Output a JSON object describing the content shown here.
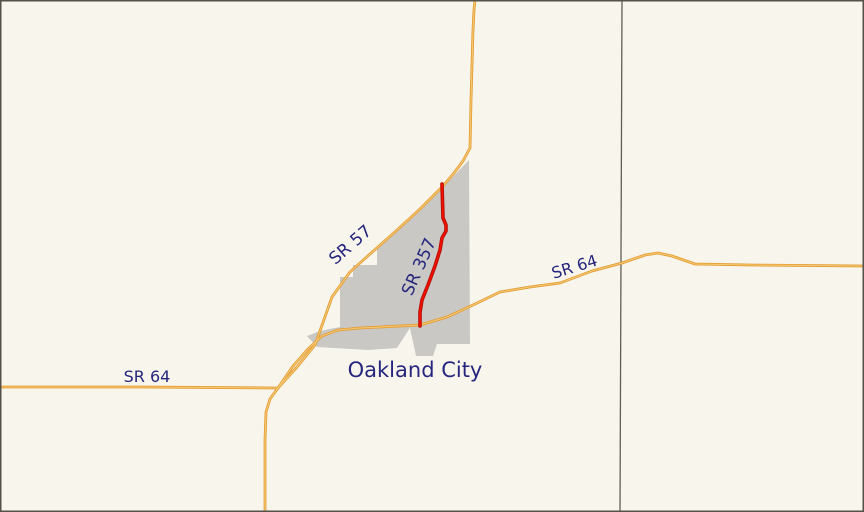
{
  "map": {
    "background_color": "#f8f6ec",
    "border_color": "#53524a"
  },
  "colors": {
    "highway_casing": "#e29d36",
    "highway_fill": "#f7c873",
    "route_casing": "#b50d00",
    "route_fill": "#f01000",
    "urban_area": "#c9c8c5",
    "boundary_line": "#5f5e56",
    "label": "#26267e"
  },
  "labels": {
    "city": {
      "text": "Oakland City"
    },
    "sr57": {
      "text": "SR 57"
    },
    "sr357": {
      "text": "SR 357"
    },
    "sr64_west": {
      "text": "SR 64"
    },
    "sr64_east": {
      "text": "SR 64"
    }
  }
}
